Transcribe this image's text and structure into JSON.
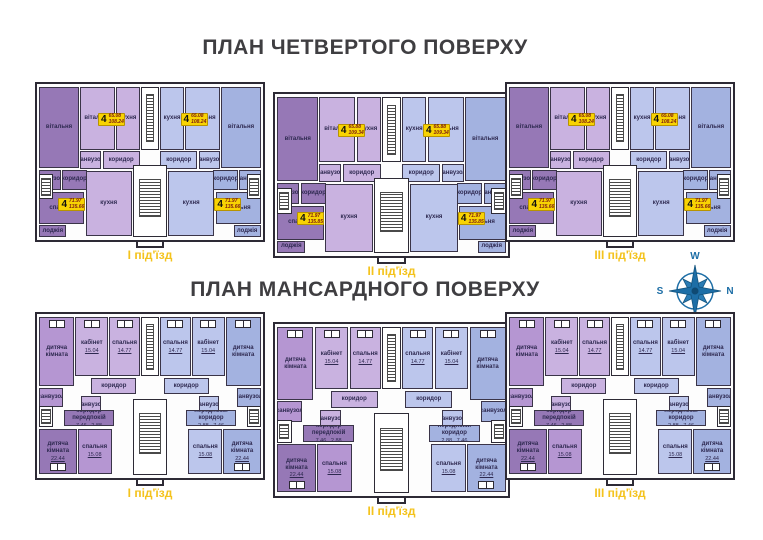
{
  "page": {
    "width": 763,
    "height": 540,
    "background": "#ffffff"
  },
  "palette": {
    "dark_purple": "#9678b6",
    "light_purple": "#c9b2e0",
    "mid_purple": "#b596d2",
    "light_blue": "#bcc6ec",
    "mid_blue": "#a3b2e0",
    "wall": "#2d2a35",
    "room_label": "#2e2950",
    "badge_bg": "#f8d303",
    "badge_area_text": "#7c1d12",
    "entrance_label": "#f4c31d",
    "title": "#3f3e41",
    "compass": "#1d6ea6"
  },
  "compass": {
    "top": "W",
    "right": "N",
    "bottom": "E",
    "left": "S"
  },
  "plans": [
    {
      "id": "fourth-floor",
      "title": "ПЛАН ЧЕТВЕРТОГО ПОВЕРХУ",
      "rooms": [
        {
          "key": "living-room",
          "label": "вітальня",
          "color": "dark_purple",
          "x": 1,
          "y": 2,
          "w": 17.5,
          "h": 52
        },
        {
          "key": "living-room",
          "label": "вітальня",
          "color": "light_purple",
          "x": 19,
          "y": 2,
          "w": 15.5,
          "h": 40
        },
        {
          "key": "kitchen",
          "label": "кухня",
          "color": "light_purple",
          "x": 35,
          "y": 2,
          "w": 10.5,
          "h": 40
        },
        {
          "key": "kitchen",
          "label": "кухня",
          "color": "light_blue",
          "x": 54.5,
          "y": 2,
          "w": 10.5,
          "h": 40
        },
        {
          "key": "living-room",
          "label": "вітальня",
          "color": "light_blue",
          "x": 65.5,
          "y": 2,
          "w": 15.5,
          "h": 40
        },
        {
          "key": "living-room",
          "label": "вітальня",
          "color": "mid_blue",
          "x": 81.5,
          "y": 2,
          "w": 17.5,
          "h": 52
        },
        {
          "key": "bathroom",
          "label": "санвузол",
          "color": "dark_purple",
          "x": 1,
          "y": 55,
          "w": 9.5,
          "h": 13
        },
        {
          "key": "corridor",
          "label": "коридор",
          "color": "dark_purple",
          "x": 11,
          "y": 55,
          "w": 11,
          "h": 13
        },
        {
          "key": "bathroom",
          "label": "санвузол",
          "color": "light_purple",
          "x": 19,
          "y": 43,
          "w": 9.5,
          "h": 11.5
        },
        {
          "key": "corridor",
          "label": "коридор",
          "color": "light_purple",
          "x": 29,
          "y": 43,
          "w": 16.5,
          "h": 11.5
        },
        {
          "key": "corridor",
          "label": "коридор",
          "color": "light_blue",
          "x": 54.5,
          "y": 43,
          "w": 16.5,
          "h": 11.5
        },
        {
          "key": "bathroom",
          "label": "санвузол",
          "color": "light_blue",
          "x": 71.5,
          "y": 43,
          "w": 9.5,
          "h": 11.5
        },
        {
          "key": "bathroom",
          "label": "санвузол",
          "color": "mid_blue",
          "x": 89.5,
          "y": 55,
          "w": 9.5,
          "h": 13
        },
        {
          "key": "corridor",
          "label": "коридор",
          "color": "mid_blue",
          "x": 78,
          "y": 55,
          "w": 11,
          "h": 13
        },
        {
          "key": "bedroom",
          "label": "спальня",
          "color": "dark_purple",
          "x": 1,
          "y": 69,
          "w": 20,
          "h": 21
        },
        {
          "key": "loggia",
          "label": "лоджія",
          "color": "dark_purple",
          "x": 1,
          "y": 90.5,
          "w": 12,
          "h": 7.5
        },
        {
          "key": "kitchen",
          "label": "кухня",
          "color": "light_purple",
          "x": 21.5,
          "y": 55.5,
          "w": 20.5,
          "h": 42
        },
        {
          "key": "kitchen",
          "label": "кухня",
          "color": "light_blue",
          "x": 58,
          "y": 55.5,
          "w": 20.5,
          "h": 42
        },
        {
          "key": "bedroom",
          "label": "спальня",
          "color": "mid_blue",
          "x": 79,
          "y": 69,
          "w": 20,
          "h": 21
        },
        {
          "key": "loggia",
          "label": "лоджія",
          "color": "mid_blue",
          "x": 87,
          "y": 90.5,
          "w": 12,
          "h": 7.5
        }
      ],
      "features": [
        {
          "type": "shaft",
          "name": "elevator-shaft",
          "x": 45.8,
          "y": 2,
          "w": 8.4,
          "h": 40
        },
        {
          "type": "core",
          "name": "stair-core",
          "x": 42.5,
          "y": 52,
          "w": 15,
          "h": 46
        },
        {
          "type": "sidestairs",
          "name": "side-stairs-left",
          "x": 0.8,
          "y": 58,
          "w": 6.5,
          "h": 16
        },
        {
          "type": "sidestairs",
          "name": "side-stairs-right",
          "x": 92.7,
          "y": 58,
          "w": 6.5,
          "h": 16
        }
      ],
      "sections": [
        {
          "name": "I",
          "entrance_label": "І під'їзд",
          "geom": {
            "x": 35,
            "y": 82,
            "w": 230,
            "h": 160
          },
          "badges": [
            {
              "rooms": "4",
              "floor_area": "65.08",
              "total_area": "108.24",
              "x": 27,
              "y": 18.5
            },
            {
              "rooms": "4",
              "floor_area": "65.08",
              "total_area": "108.24",
              "x": 63.5,
              "y": 18.5
            },
            {
              "rooms": "4",
              "floor_area": "71.97",
              "total_area": "135.66",
              "x": 9.5,
              "y": 73
            },
            {
              "rooms": "4",
              "floor_area": "71.97",
              "total_area": "135.66",
              "x": 78.5,
              "y": 73
            }
          ]
        },
        {
          "name": "II",
          "entrance_label": "ІІ під'їзд",
          "geom": {
            "x": 273,
            "y": 92,
            "w": 237,
            "h": 166
          },
          "badges": [
            {
              "rooms": "4",
              "floor_area": "65.88",
              "total_area": "109.34",
              "x": 27,
              "y": 18.5
            },
            {
              "rooms": "4",
              "floor_area": "65.88",
              "total_area": "109.34",
              "x": 63.5,
              "y": 18.5
            },
            {
              "rooms": "4",
              "floor_area": "71.97",
              "total_area": "135.85",
              "x": 9.5,
              "y": 73
            },
            {
              "rooms": "4",
              "floor_area": "71.97",
              "total_area": "135.85",
              "x": 78.5,
              "y": 73
            }
          ]
        },
        {
          "name": "III",
          "entrance_label": "ІІІ під'їзд",
          "geom": {
            "x": 505,
            "y": 82,
            "w": 230,
            "h": 160
          },
          "badges": [
            {
              "rooms": "4",
              "floor_area": "65.08",
              "total_area": "108.24",
              "x": 27,
              "y": 18.5
            },
            {
              "rooms": "4",
              "floor_area": "65.08",
              "total_area": "108.24",
              "x": 63.5,
              "y": 18.5
            },
            {
              "rooms": "4",
              "floor_area": "71.97",
              "total_area": "135.66",
              "x": 9.5,
              "y": 73
            },
            {
              "rooms": "4",
              "floor_area": "71.97",
              "total_area": "135.66",
              "x": 78.5,
              "y": 73
            }
          ]
        }
      ]
    },
    {
      "id": "mansard",
      "title": "ПЛАН МАНСАРДНОГО ПОВЕРХУ",
      "rooms": [
        {
          "key": "children-room",
          "label": "дитяча кімната",
          "color": "mid_purple",
          "x": 1,
          "y": 2,
          "w": 15.5,
          "h": 42,
          "win": "top"
        },
        {
          "key": "study",
          "label": "кабінет",
          "area": "15.04",
          "color": "light_purple",
          "x": 17,
          "y": 2,
          "w": 14.5,
          "h": 36,
          "win": "top"
        },
        {
          "key": "bedroom",
          "label": "спальня",
          "area": "14.77",
          "color": "light_purple",
          "x": 32,
          "y": 2,
          "w": 13.5,
          "h": 36,
          "win": "top"
        },
        {
          "key": "bedroom",
          "label": "спальня",
          "area": "14.77",
          "color": "light_blue",
          "x": 54.5,
          "y": 2,
          "w": 13.5,
          "h": 36,
          "win": "top"
        },
        {
          "key": "study",
          "label": "кабінет",
          "area": "15.04",
          "color": "light_blue",
          "x": 68.5,
          "y": 2,
          "w": 14.5,
          "h": 36,
          "win": "top"
        },
        {
          "key": "children-room",
          "label": "дитяча кімната",
          "color": "mid_blue",
          "x": 83.5,
          "y": 2,
          "w": 15.5,
          "h": 42,
          "win": "top"
        },
        {
          "key": "corridor",
          "label": "коридор",
          "color": "light_purple",
          "x": 24,
          "y": 39,
          "w": 20,
          "h": 10
        },
        {
          "key": "corridor",
          "label": "коридор",
          "color": "light_blue",
          "x": 56,
          "y": 39,
          "w": 20,
          "h": 10
        },
        {
          "key": "bathroom",
          "label": "санвузол",
          "color": "mid_purple",
          "x": 1,
          "y": 45,
          "w": 10.5,
          "h": 12
        },
        {
          "key": "bathroom",
          "label": "санвузол",
          "color": "light_purple",
          "x": 19.5,
          "y": 50,
          "w": 9,
          "h": 11
        },
        {
          "key": "bathroom",
          "label": "санвузол",
          "color": "light_blue",
          "x": 71.5,
          "y": 50,
          "w": 9,
          "h": 11
        },
        {
          "key": "bathroom",
          "label": "санвузол",
          "color": "mid_blue",
          "x": 88.5,
          "y": 45,
          "w": 10.5,
          "h": 12
        },
        {
          "key": "hallway",
          "label": "коридор передпокій",
          "area": "7.46   2.88",
          "color": "dark_purple",
          "x": 12,
          "y": 58.5,
          "w": 22,
          "h": 10
        },
        {
          "key": "hallway",
          "label": "передпокій коридор",
          "area": "2.88   7.46",
          "color": "mid_blue",
          "x": 66,
          "y": 58.5,
          "w": 22,
          "h": 10
        },
        {
          "key": "children-room",
          "label": "дитяча кімната",
          "area": "22.44",
          "color": "dark_purple",
          "x": 1,
          "y": 70,
          "w": 16.5,
          "h": 27.5,
          "win": "bottom"
        },
        {
          "key": "bedroom",
          "label": "спальня",
          "area": "15.08",
          "color": "mid_purple",
          "x": 18,
          "y": 70,
          "w": 15,
          "h": 27.5
        },
        {
          "key": "bedroom",
          "label": "спальня",
          "area": "15.08",
          "color": "light_blue",
          "x": 67,
          "y": 70,
          "w": 15,
          "h": 27.5
        },
        {
          "key": "children-room",
          "label": "дитяча кімната",
          "area": "22.44",
          "color": "mid_blue",
          "x": 82.5,
          "y": 70,
          "w": 16.5,
          "h": 27.5,
          "win": "bottom"
        }
      ],
      "features": [
        {
          "type": "shaft",
          "name": "ventilation-shaft",
          "x": 46,
          "y": 2,
          "w": 8,
          "h": 36
        },
        {
          "type": "core",
          "name": "stair-core",
          "x": 42.5,
          "y": 52,
          "w": 15,
          "h": 46
        },
        {
          "type": "sidestairs",
          "name": "side-stairs-left",
          "x": 0.8,
          "y": 56,
          "w": 6.5,
          "h": 13
        },
        {
          "type": "sidestairs",
          "name": "side-stairs-right",
          "x": 92.7,
          "y": 56,
          "w": 6.5,
          "h": 13
        }
      ],
      "sections": [
        {
          "name": "I",
          "entrance_label": "І під'їзд",
          "geom": {
            "x": 35,
            "y": 312,
            "w": 230,
            "h": 168
          },
          "badges": []
        },
        {
          "name": "II",
          "entrance_label": "ІІ під'їзд",
          "geom": {
            "x": 273,
            "y": 322,
            "w": 237,
            "h": 176
          },
          "badges": []
        },
        {
          "name": "III",
          "entrance_label": "ІІІ під'їзд",
          "geom": {
            "x": 505,
            "y": 312,
            "w": 230,
            "h": 168
          },
          "badges": []
        }
      ]
    }
  ]
}
